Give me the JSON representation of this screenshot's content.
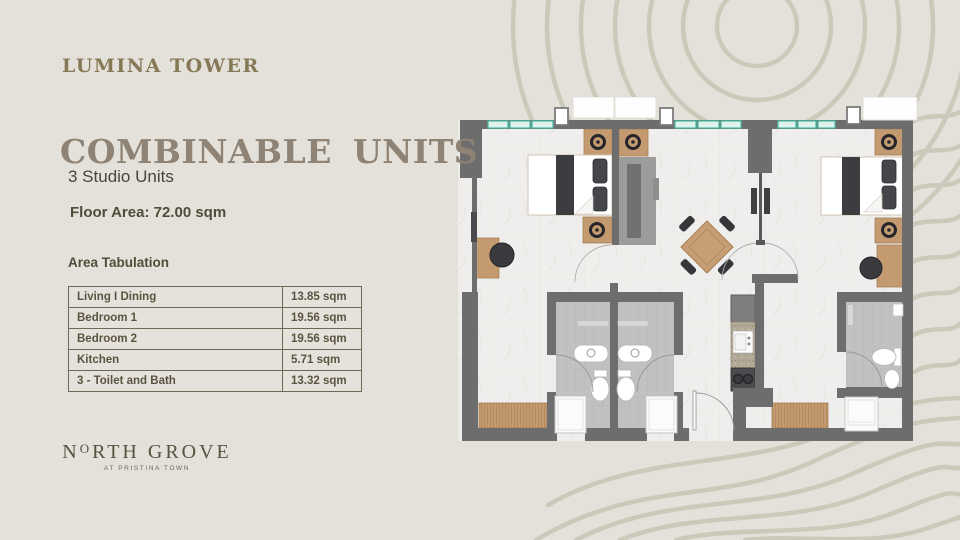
{
  "slide": {
    "project_name": "LUMINA TOWER",
    "title": "COMBINABLE UNITS",
    "subtitle": "3 Studio Units",
    "floor_area": "Floor Area: 72.00 sqm",
    "table_heading": "Area Tabulation"
  },
  "area_table": {
    "rows": [
      {
        "label": "Living I Dining",
        "value": "13.85 sqm"
      },
      {
        "label": "Bedroom 1",
        "value": "19.56 sqm"
      },
      {
        "label": "Bedroom 2",
        "value": "19.56 sqm"
      },
      {
        "label": "Kitchen",
        "value": "5.71 sqm"
      },
      {
        "label": "3 - Toilet and Bath",
        "value": "13.32 sqm"
      }
    ]
  },
  "logo": {
    "name_n": "N",
    "name_o": "O",
    "name_rest": "RTH GROVE",
    "tagline": "AT PRISTINA TOWN"
  },
  "colors": {
    "background": "#e3e1d9",
    "contour_line": "#c9c5b5",
    "brand_gold": "#877957",
    "title_taupe": "#8e8374",
    "body_text": "#4c443a",
    "table_border": "#6f6855",
    "logo_text": "#56523f",
    "wall_gray": "#6d6d6e",
    "window_teal": "#49bfa6",
    "wood": "#c49b71",
    "floor_light": "#efeeec",
    "tile_gray": "#c2c1c0",
    "furniture_dark": "#3c3d41"
  }
}
